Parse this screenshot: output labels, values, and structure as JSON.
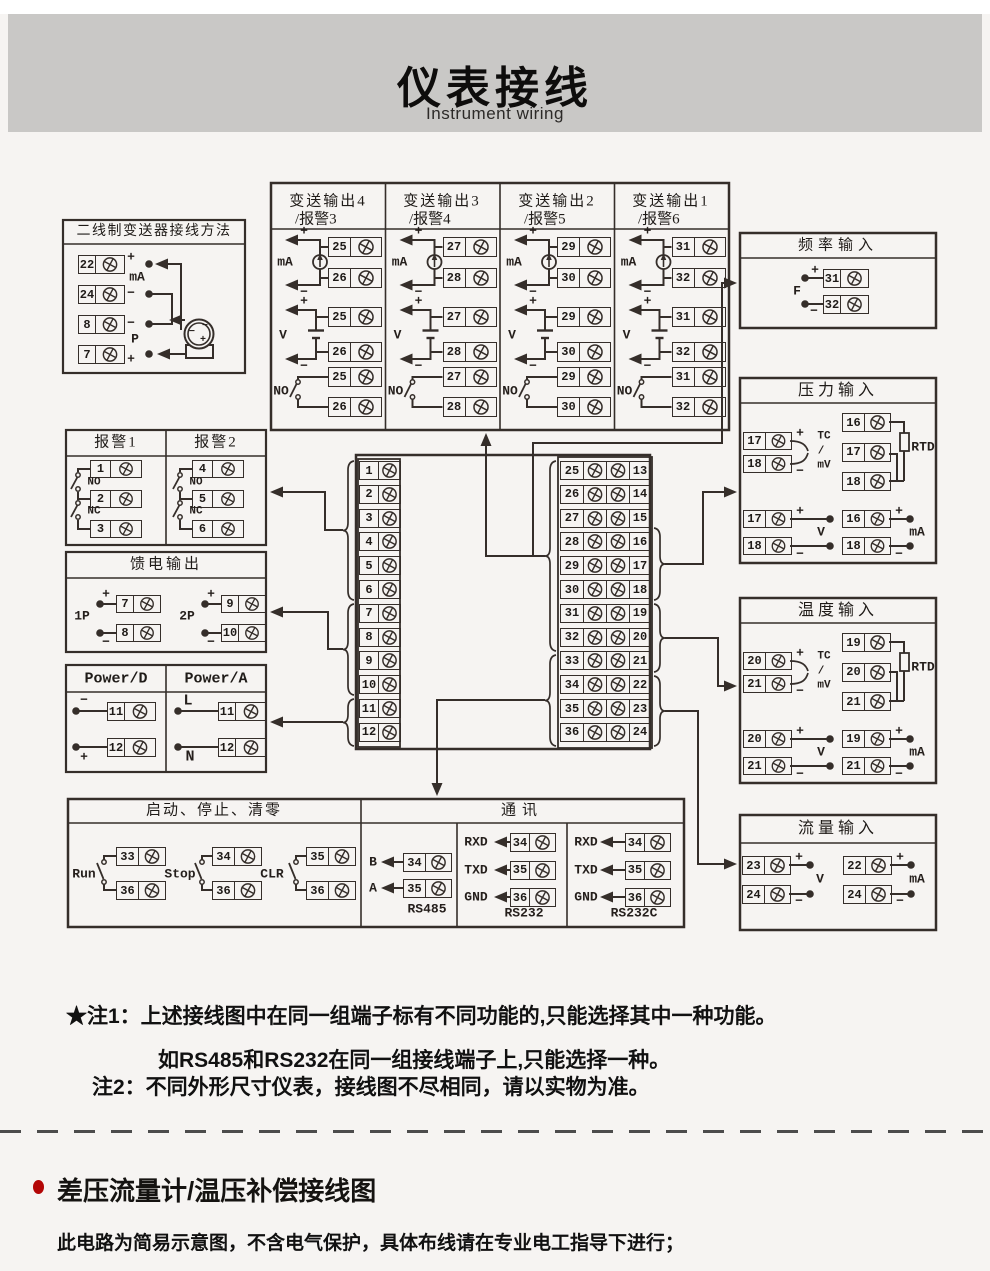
{
  "header": {
    "title": "仪表接线",
    "subtitle": "Instrument wiring"
  },
  "colors": {
    "accent_red": "#b30606",
    "band_gray": "#c9c8c6",
    "ink": "#352e2a"
  },
  "g": {
    "plus": "+",
    "minus": "−",
    "ma": "mA",
    "v": "V",
    "f": "F",
    "p": "P",
    "no": "NO",
    "nc": "NC",
    "tc": "TC",
    "slash": "/",
    "mv": "mV",
    "rtd": "RTD",
    "p1": "1P",
    "p2": "2P",
    "l": "L",
    "n": "N",
    "b": "B",
    "a": "A",
    "rxd": "RXD",
    "txd": "TXD",
    "gnd": "GND"
  },
  "boxes": {
    "two_wire": {
      "title": "二线制变送器接线方法",
      "terminals": [
        "22",
        "24",
        "8",
        "7"
      ]
    },
    "transmit": {
      "cols": [
        {
          "title1": "变送输出4",
          "title2": "/报警3",
          "ma": [
            "25",
            "26"
          ],
          "v": [
            "25",
            "26"
          ],
          "no": [
            "25",
            "26"
          ]
        },
        {
          "title1": "变送输出3",
          "title2": "/报警4",
          "ma": [
            "27",
            "28"
          ],
          "v": [
            "27",
            "28"
          ],
          "no": [
            "27",
            "28"
          ]
        },
        {
          "title1": "变送输出2",
          "title2": "/报警5",
          "ma": [
            "29",
            "30"
          ],
          "v": [
            "29",
            "30"
          ],
          "no": [
            "29",
            "30"
          ]
        },
        {
          "title1": "变送输出1",
          "title2": "/报警6",
          "ma": [
            "31",
            "32"
          ],
          "v": [
            "31",
            "32"
          ],
          "no": [
            "31",
            "32"
          ]
        }
      ]
    },
    "freq": {
      "title": "频率输入",
      "terminals": [
        "31",
        "32"
      ]
    },
    "pressure": {
      "title": "压力输入",
      "tc": [
        "17",
        "18"
      ],
      "rtd": [
        "16",
        "17",
        "18"
      ],
      "volt": [
        "17",
        "18"
      ],
      "amp": [
        "16",
        "18"
      ]
    },
    "temp": {
      "title": "温度输入",
      "tc": [
        "20",
        "21"
      ],
      "rtd": [
        "19",
        "20",
        "21"
      ],
      "volt": [
        "20",
        "21"
      ],
      "amp": [
        "19",
        "21"
      ]
    },
    "flow": {
      "title": "流量输入",
      "volt": [
        "23",
        "24"
      ],
      "amp": [
        "22",
        "24"
      ]
    },
    "alarm": {
      "title1": "报警1",
      "title2": "报警2",
      "t1": [
        "1",
        "2",
        "3"
      ],
      "t2": [
        "4",
        "5",
        "6"
      ]
    },
    "feed": {
      "title": "馈电输出",
      "t1": [
        "7",
        "8"
      ],
      "t2": [
        "9",
        "10"
      ]
    },
    "power": {
      "title1": "Power/D",
      "title2": "Power/A",
      "t1": [
        "11",
        "12"
      ],
      "t2": [
        "11",
        "12"
      ]
    },
    "runstop": {
      "title": "启动、停止、清零",
      "switches": [
        "Run",
        "Stop",
        "CLR"
      ],
      "run": [
        "33",
        "36"
      ],
      "stop": [
        "34",
        "36"
      ],
      "clr": [
        "35",
        "36"
      ]
    },
    "comm": {
      "title": "通讯",
      "cols": [
        "RS485",
        "RS232",
        "RS232C"
      ],
      "rs485": [
        "34",
        "35"
      ],
      "rs232": [
        "34",
        "35",
        "36"
      ],
      "rs232c": [
        "34",
        "35",
        "36"
      ]
    }
  },
  "center": {
    "left": [
      "1",
      "2",
      "3",
      "4",
      "5",
      "6",
      "7",
      "8",
      "9",
      "10",
      "11",
      "12"
    ],
    "inner_left": [
      "25",
      "26",
      "27",
      "28",
      "29",
      "30",
      "31",
      "32",
      "33",
      "34",
      "35",
      "36"
    ],
    "inner_right": [
      "13",
      "14",
      "15",
      "16",
      "17",
      "18",
      "19",
      "20",
      "21",
      "22",
      "23",
      "24"
    ]
  },
  "notes": {
    "n1": "★注1：上述接线图中在同一组端子标有不同功能的,只能选择其中一种功能。",
    "n2": "如RS485和RS232在同一组接线端子上,只能选择一种。",
    "n3": "注2：不同外形尺寸仪表，接线图不尽相同，请以实物为准。"
  },
  "footer": {
    "heading": "差压流量计/温压补偿接线图",
    "body": "此电路为简易示意图，不含电气保护，具体布线请在专业电工指导下进行；"
  }
}
